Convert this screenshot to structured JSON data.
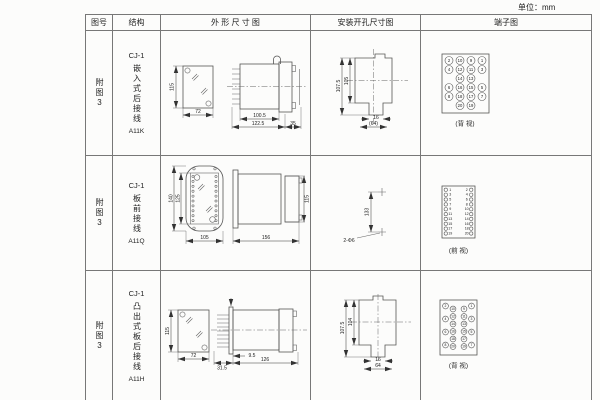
{
  "unit_label": "单位：mm",
  "headers": {
    "fig": "图号",
    "struct": "结构",
    "outline": "外 形 尺 寸 图",
    "install": "安装开孔尺寸图",
    "terminal": "端子图"
  },
  "rows": [
    {
      "fig": "附图3",
      "series": "CJ-1",
      "struct_text": "嵌入式后接线",
      "model": "A11K",
      "outline": {
        "front_h": "115",
        "front_w": "72",
        "d_body": "100.5",
        "d_total": "122.5",
        "d_flange": "35"
      },
      "install": {
        "h_outer": "107.5",
        "h_inner": "105",
        "w_slot": "16",
        "w_tab": "(64)"
      },
      "terminal_view": "(背 视)",
      "terminals": [
        {
          "x": 27,
          "y": 29.5,
          "n": "2"
        },
        {
          "x": 38,
          "y": 29.5,
          "n": "10"
        },
        {
          "x": 49,
          "y": 29.5,
          "n": "9"
        },
        {
          "x": 60,
          "y": 29.5,
          "n": "1"
        },
        {
          "x": 27,
          "y": 38.5,
          "n": "4"
        },
        {
          "x": 38,
          "y": 38.5,
          "n": "12"
        },
        {
          "x": 49,
          "y": 38.5,
          "n": "11"
        },
        {
          "x": 60,
          "y": 38.5,
          "n": "3"
        },
        {
          "x": 38,
          "y": 47.5,
          "n": "14"
        },
        {
          "x": 49,
          "y": 47.5,
          "n": "13"
        },
        {
          "x": 27,
          "y": 56.5,
          "n": "6"
        },
        {
          "x": 38,
          "y": 56.5,
          "n": "16"
        },
        {
          "x": 49,
          "y": 56.5,
          "n": "15"
        },
        {
          "x": 60,
          "y": 56.5,
          "n": "5"
        },
        {
          "x": 27,
          "y": 65.5,
          "n": "8"
        },
        {
          "x": 38,
          "y": 65.5,
          "n": "18"
        },
        {
          "x": 49,
          "y": 65.5,
          "n": "17"
        },
        {
          "x": 60,
          "y": 65.5,
          "n": "7"
        },
        {
          "x": 38,
          "y": 74.5,
          "n": "20"
        },
        {
          "x": 49,
          "y": 74.5,
          "n": "19"
        }
      ]
    },
    {
      "fig": "附图3",
      "series": "CJ-1",
      "struct_text": "板前接线",
      "model": "A11Q",
      "outline": {
        "front_h_outer": "140",
        "front_h_inner": "125",
        "front_w": "105",
        "side_d": "156",
        "side_h": "115"
      },
      "install": {
        "span": "133",
        "holes": "2-Φ6"
      },
      "terminal_view": "(前 视)",
      "terminals": [
        {
          "x": 23.8,
          "y": 33.8,
          "n": "1",
          "tx": 28.3
        },
        {
          "x": 49.2,
          "y": 33.8,
          "n": "2",
          "tx": 44.7
        },
        {
          "x": 23.8,
          "y": 38.7,
          "n": "3",
          "tx": 28.3
        },
        {
          "x": 49.2,
          "y": 38.7,
          "n": "4",
          "tx": 44.7
        },
        {
          "x": 23.8,
          "y": 43.5,
          "n": "5",
          "tx": 28.3
        },
        {
          "x": 49.2,
          "y": 43.5,
          "n": "6",
          "tx": 44.7
        },
        {
          "x": 23.8,
          "y": 48.4,
          "n": "7",
          "tx": 28.3
        },
        {
          "x": 49.2,
          "y": 48.4,
          "n": "8",
          "tx": 44.7
        },
        {
          "x": 23.8,
          "y": 53.2,
          "n": "9",
          "tx": 28.3
        },
        {
          "x": 49.2,
          "y": 53.2,
          "n": "10",
          "tx": 44.7
        },
        {
          "x": 23.8,
          "y": 58.1,
          "n": "11",
          "tx": 28.3
        },
        {
          "x": 49.2,
          "y": 58.1,
          "n": "12",
          "tx": 44.7
        },
        {
          "x": 23.8,
          "y": 62.9,
          "n": "13",
          "tx": 28.3
        },
        {
          "x": 49.2,
          "y": 62.9,
          "n": "14",
          "tx": 44.7
        },
        {
          "x": 23.8,
          "y": 67.8,
          "n": "15",
          "tx": 28.3
        },
        {
          "x": 49.2,
          "y": 67.8,
          "n": "16",
          "tx": 44.7
        },
        {
          "x": 23.8,
          "y": 72.6,
          "n": "17",
          "tx": 28.3
        },
        {
          "x": 49.2,
          "y": 72.6,
          "n": "18",
          "tx": 44.7
        },
        {
          "x": 23.8,
          "y": 77.5,
          "n": "19",
          "tx": 28.3
        },
        {
          "x": 49.2,
          "y": 77.5,
          "n": "20",
          "tx": 44.7
        }
      ]
    },
    {
      "fig": "附图3",
      "series": "CJ-1",
      "struct_text": "凸出式板后接线",
      "model": "A11H",
      "outline": {
        "front_h": "115",
        "front_w": "72",
        "d_comb": "31.5",
        "d_plate": "9.5",
        "d_body": "126"
      },
      "install": {
        "h_outer": "107.5",
        "h_inner": "104",
        "w_slot": "16",
        "w_tab": "64"
      },
      "terminal_view": "(背 视)",
      "terminals": [
        {
          "x": 23.5,
          "y": 34,
          "n": "2"
        },
        {
          "x": 49.5,
          "y": 34,
          "n": "1"
        },
        {
          "x": 31,
          "y": 37,
          "n": "10"
        },
        {
          "x": 42,
          "y": 37,
          "n": "9"
        },
        {
          "x": 31,
          "y": 44.5,
          "n": "12"
        },
        {
          "x": 42,
          "y": 44.5,
          "n": "11"
        },
        {
          "x": 23.5,
          "y": 47,
          "n": "4"
        },
        {
          "x": 49.5,
          "y": 47,
          "n": "3"
        },
        {
          "x": 31,
          "y": 52,
          "n": "14"
        },
        {
          "x": 42,
          "y": 52,
          "n": "13"
        },
        {
          "x": 31,
          "y": 59.5,
          "n": "16"
        },
        {
          "x": 42,
          "y": 59.5,
          "n": "15"
        },
        {
          "x": 23.5,
          "y": 60,
          "n": "6"
        },
        {
          "x": 49.5,
          "y": 60,
          "n": "5"
        },
        {
          "x": 31,
          "y": 67,
          "n": "18"
        },
        {
          "x": 42,
          "y": 67,
          "n": "17"
        },
        {
          "x": 23.5,
          "y": 73,
          "n": "8"
        },
        {
          "x": 49.5,
          "y": 73,
          "n": "7"
        },
        {
          "x": 31,
          "y": 74.5,
          "n": "20"
        },
        {
          "x": 42,
          "y": 74.5,
          "n": "19"
        }
      ]
    }
  ]
}
